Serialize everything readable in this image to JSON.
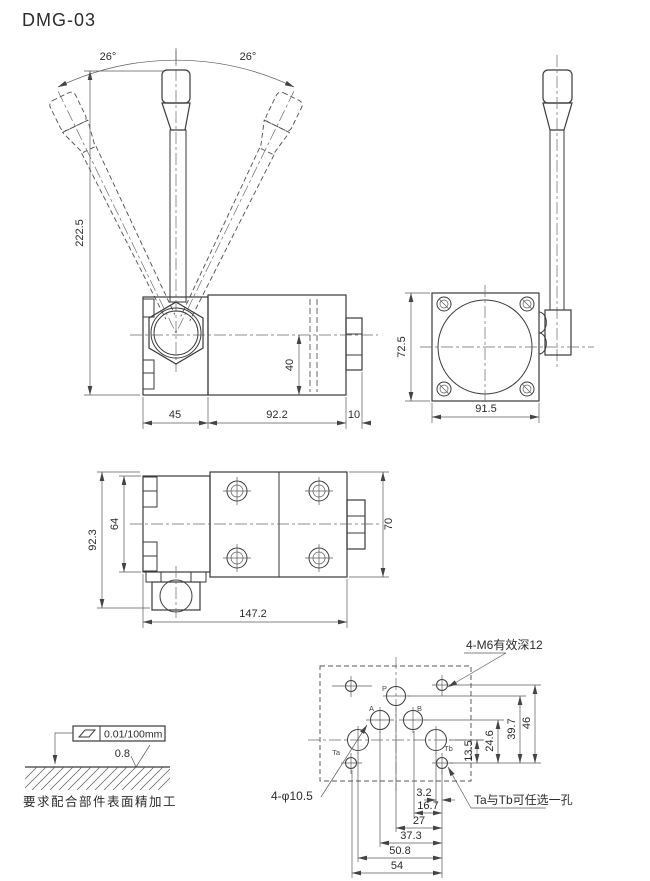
{
  "title": "DMG-03",
  "front_view": {
    "angle_left": "26°",
    "angle_right": "26°",
    "dims": {
      "overall_height": "222.5",
      "housing_width": "45",
      "body_length": "92.2",
      "end_nut": "10",
      "port_offset": "40"
    }
  },
  "side_view": {
    "dims": {
      "height": "72.5",
      "width": "91.5"
    }
  },
  "bottom_view": {
    "dims": {
      "overall_height": "92.3",
      "housing_height": "64",
      "body_height": "70",
      "overall_length": "147.2"
    }
  },
  "mounting_pattern": {
    "callout_m6": "4-M6有效深12",
    "callout_port_dia": "4-φ10.5",
    "callout_ta_tb": "Ta与Tb可任选一孔",
    "port_labels": {
      "p": "P",
      "a": "A",
      "b": "B",
      "ta": "Ta",
      "tb": "Tb"
    },
    "vertical_dims": [
      "13.5",
      "24.6",
      "39.7",
      "46"
    ],
    "horizontal_dims": [
      "3.2",
      "16.7",
      "27",
      "37.3",
      "50.8",
      "54"
    ]
  },
  "surface_note": {
    "flatness_tolerance": "0.01/100mm",
    "roughness": "0.8",
    "caption": "要求配合部件表面精加工"
  }
}
